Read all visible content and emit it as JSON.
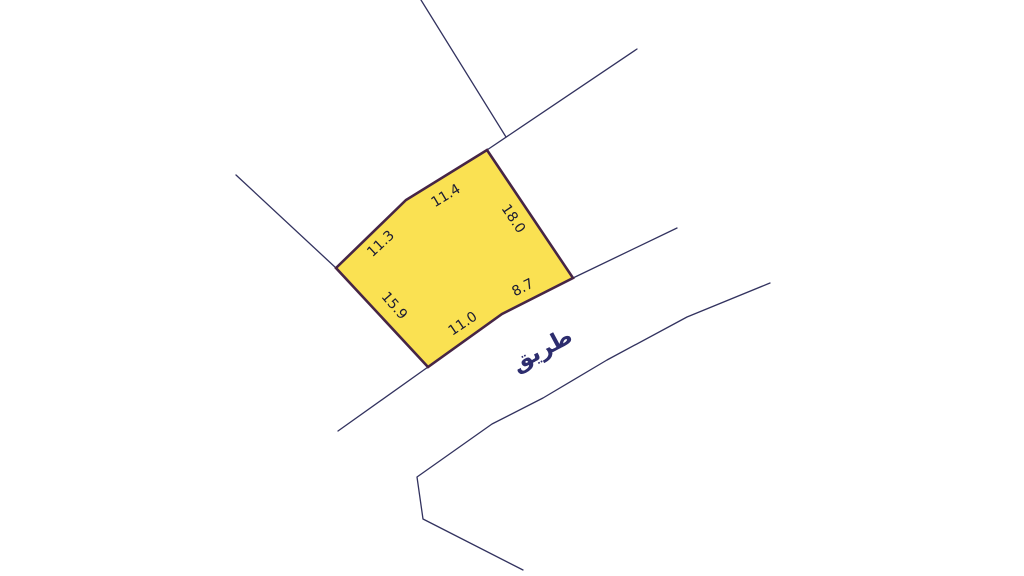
{
  "page": {
    "background": "#ffffff",
    "width": 1024,
    "height": 576
  },
  "map": {
    "parcel": {
      "fill": "#FAE152",
      "stroke": "#462546",
      "stroke_width": 2.6,
      "vertices": [
        [
          487,
          150
        ],
        [
          573,
          278
        ],
        [
          502,
          314
        ],
        [
          428,
          367
        ],
        [
          336,
          268
        ],
        [
          406,
          200
        ]
      ],
      "label_color": "#1B1B33",
      "label_font_size": 14,
      "dimension_labels": [
        {
          "text": "11.4",
          "x": 446,
          "y": 196,
          "angle": -31
        },
        {
          "text": "18.0",
          "x": 513,
          "y": 219,
          "angle": 56
        },
        {
          "text": "8.7",
          "x": 523,
          "y": 288,
          "angle": -27
        },
        {
          "text": "11.0",
          "x": 463,
          "y": 324,
          "angle": -34
        },
        {
          "text": "15.9",
          "x": 394,
          "y": 306,
          "angle": 49
        },
        {
          "text": "11.3",
          "x": 381,
          "y": 244,
          "angle": -43
        }
      ]
    },
    "roads": {
      "stroke": "#32325F",
      "stroke_width": 1.3,
      "polylines": [
        [
          [
            421,
            0
          ],
          [
            506,
            137
          ]
        ],
        [
          [
            487,
            150
          ],
          [
            637,
            49
          ]
        ],
        [
          [
            236,
            175
          ],
          [
            336,
            268
          ]
        ],
        [
          [
            428,
            367
          ],
          [
            338,
            431
          ]
        ],
        [
          [
            573,
            278
          ],
          [
            677,
            228
          ]
        ],
        [
          [
            770,
            283
          ],
          [
            687,
            317
          ],
          [
            607,
            360
          ],
          [
            543,
            398
          ],
          [
            492,
            424
          ],
          [
            417,
            477
          ],
          [
            423,
            519
          ],
          [
            523,
            570
          ]
        ]
      ],
      "label": {
        "text": "طريق",
        "x": 542,
        "y": 350,
        "angle": -28,
        "color": "#2D2D6E",
        "font_size": 23
      }
    }
  }
}
